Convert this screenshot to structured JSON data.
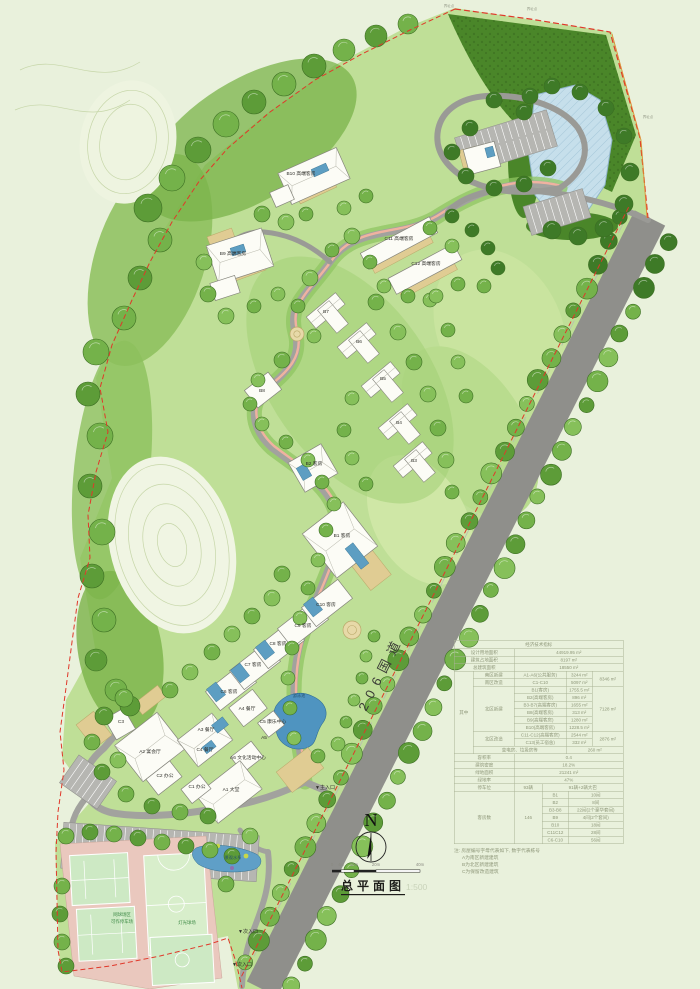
{
  "plan_title": {
    "text": "总平面图",
    "scale": "1:500"
  },
  "north_arrow": {
    "label": "N"
  },
  "scale_bar": {
    "ticks": [
      "0",
      "4m",
      "10m",
      "20m",
      "40m"
    ]
  },
  "colors": {
    "boundary_red": "#e0382a",
    "water_blue": "#5f9fc7",
    "road_gray": "#8f8f8b",
    "court_green": "#cde9c4",
    "table_text": "#8e9779"
  },
  "plan": {
    "road_label": {
      "name": "label-road-206",
      "text": "206国道"
    },
    "labels": [
      {
        "name": "label-b10",
        "text": "B10 高端客房",
        "x": 301,
        "y": 175
      },
      {
        "name": "label-b9",
        "text": "B9 高端客房",
        "x": 233,
        "y": 255
      },
      {
        "name": "label-c11",
        "text": "C11 高端客房",
        "x": 399,
        "y": 240
      },
      {
        "name": "label-c12",
        "text": "C12 高端客房",
        "x": 426,
        "y": 265
      },
      {
        "name": "label-b7",
        "text": "B7",
        "x": 326,
        "y": 313
      },
      {
        "name": "label-b6",
        "text": "B6",
        "x": 359,
        "y": 343
      },
      {
        "name": "label-b5",
        "text": "B5",
        "x": 383,
        "y": 380
      },
      {
        "name": "label-b4",
        "text": "B4",
        "x": 399,
        "y": 424
      },
      {
        "name": "label-b3",
        "text": "B3",
        "x": 414,
        "y": 462
      },
      {
        "name": "label-b8",
        "text": "B8",
        "x": 262,
        "y": 392
      },
      {
        "name": "label-b2",
        "text": "B2 客房",
        "x": 314,
        "y": 465
      },
      {
        "name": "label-b1",
        "text": "B1 客房",
        "x": 342,
        "y": 537
      },
      {
        "name": "label-c10",
        "text": "C10 客房",
        "x": 326,
        "y": 606
      },
      {
        "name": "label-c9",
        "text": "C9 客房",
        "x": 303,
        "y": 627
      },
      {
        "name": "label-c8",
        "text": "C8 客房",
        "x": 278,
        "y": 645
      },
      {
        "name": "label-c7",
        "text": "C7 客房",
        "x": 253,
        "y": 666
      },
      {
        "name": "label-c6",
        "text": "C6 客房",
        "x": 229,
        "y": 693
      },
      {
        "name": "label-a4",
        "text": "A4 餐厅",
        "x": 247,
        "y": 710
      },
      {
        "name": "label-c5",
        "text": "C5 康乐中心",
        "x": 273,
        "y": 723
      },
      {
        "name": "label-a5",
        "text": "A5",
        "x": 264,
        "y": 739
      },
      {
        "name": "label-a3",
        "text": "A3 餐厅",
        "x": 206,
        "y": 731
      },
      {
        "name": "label-c4",
        "text": "C4 餐厅",
        "x": 205,
        "y": 751
      },
      {
        "name": "label-a2",
        "text": "A2 宴会厅",
        "x": 150,
        "y": 753
      },
      {
        "name": "label-a6",
        "text": "A6 文化活动中心",
        "x": 248,
        "y": 759
      },
      {
        "name": "label-c3",
        "text": "C3",
        "x": 121,
        "y": 723
      },
      {
        "name": "label-c2",
        "text": "C2 办公",
        "x": 165,
        "y": 777
      },
      {
        "name": "label-c1",
        "text": "C1 办公",
        "x": 197,
        "y": 788
      },
      {
        "name": "label-a1",
        "text": "A1 大堂",
        "x": 231,
        "y": 791
      },
      {
        "name": "label-pool",
        "text": "游泳池",
        "x": 299,
        "y": 697,
        "size": 4.2,
        "color": "#24506e"
      },
      {
        "name": "label-water-feature",
        "text": "景观水系",
        "x": 233,
        "y": 859,
        "size": 4.2,
        "color": "#24506e"
      },
      {
        "name": "label-courts-note-1",
        "text": "网球场区",
        "x": 122,
        "y": 916,
        "size": 4.4,
        "color": "#3e8a46"
      },
      {
        "name": "label-courts-note-2",
        "text": "可作停车场",
        "x": 122,
        "y": 923,
        "size": 4.4,
        "color": "#3e8a46"
      },
      {
        "name": "label-lit-court",
        "text": "灯光球场",
        "x": 187,
        "y": 924,
        "size": 4.4,
        "color": "#3e8a46"
      },
      {
        "name": "label-main-entrance",
        "text": "▼主入口",
        "x": 325,
        "y": 789,
        "size": 5
      },
      {
        "name": "label-secondary-entrance-1",
        "text": "▼次入口",
        "x": 248,
        "y": 933,
        "size": 5
      },
      {
        "name": "label-secondary-entrance-2",
        "text": "▼次入口",
        "x": 242,
        "y": 966,
        "size": 5
      },
      {
        "name": "label-boundary-pt-1",
        "text": "界址点",
        "x": 449,
        "y": 7,
        "size": 3.5,
        "color": "#9aa08e"
      },
      {
        "name": "label-boundary-pt-2",
        "text": "界址点",
        "x": 532,
        "y": 10,
        "size": 3.5,
        "color": "#9aa08e"
      },
      {
        "name": "label-boundary-pt-3",
        "text": "界址点",
        "x": 648,
        "y": 118,
        "size": 3.5,
        "color": "#9aa08e"
      }
    ]
  },
  "table": {
    "title": "经济技术指标",
    "land_area_label": "设计用地面积",
    "land_area_value": "44919.95 m²",
    "footprint_label": "建筑占地面积",
    "footprint_value": "8197 m²",
    "gfa_label": "总建筑面积",
    "gfa_value": "18550 m²",
    "among_label": "其中",
    "south_new_label": "南区新建",
    "south_new_item": "A1-A6(公共服务)",
    "south_new_value": "3244 m²",
    "south_reno_label": "南区改造",
    "south_reno_item": "C1-C10",
    "south_reno_value": "5097 m²",
    "south_subtotal": "8346 m²",
    "north_new_label": "北区新建",
    "north_new_items": [
      [
        "B1(客房)",
        "1755.5 m²"
      ],
      [
        "B2(高端客房)",
        "896 m²"
      ],
      [
        "B3-B7(高端客房)",
        "1655 m²"
      ],
      [
        "B8(高端客房)",
        "313 m²"
      ],
      [
        "B9(高端客房)",
        "1280 m²"
      ],
      [
        "B10(高端客房)",
        "1228.5 m²"
      ]
    ],
    "north_subtotal": "7128 m²",
    "north_reno_label": "北区改造",
    "north_reno_items": [
      [
        "C11-C12(高端客房)",
        "2544 m²"
      ],
      [
        "C13(员工宿舍)",
        "332 m²"
      ]
    ],
    "north_reno_subtotal": "2876 m²",
    "utility_label": "变电房、垃圾房等",
    "utility_value": "260 m²",
    "far_label": "容积率",
    "far_value": "0.4",
    "density_label": "建筑密度",
    "density_value": "18.2%",
    "green_area_label": "绿地面积",
    "green_area_value": "21241 m²",
    "green_rate_label": "绿地率",
    "green_rate_value": "47%",
    "parking_label": "停车位",
    "parking_count": "93辆",
    "parking_detail": "91辆+2辆大巴",
    "rooms_label": "客房数",
    "rooms_total": "146",
    "rooms_items": [
      [
        "B1",
        "10间"
      ],
      [
        "B2",
        "8间"
      ],
      [
        "B3-B8",
        "22间(2个豪华套间)"
      ],
      [
        "B9",
        "4间(2个套间)"
      ],
      [
        "B10",
        "18间"
      ],
      [
        "C11C12",
        "28间"
      ],
      [
        "C6-C10",
        "56间"
      ]
    ]
  },
  "notes": {
    "title": "注: 房屋编号字母代表如下, 数字代表栋号",
    "lines": [
      "A为南区新建建筑",
      "B为北区新建建筑",
      "C为保留改造建筑"
    ]
  }
}
